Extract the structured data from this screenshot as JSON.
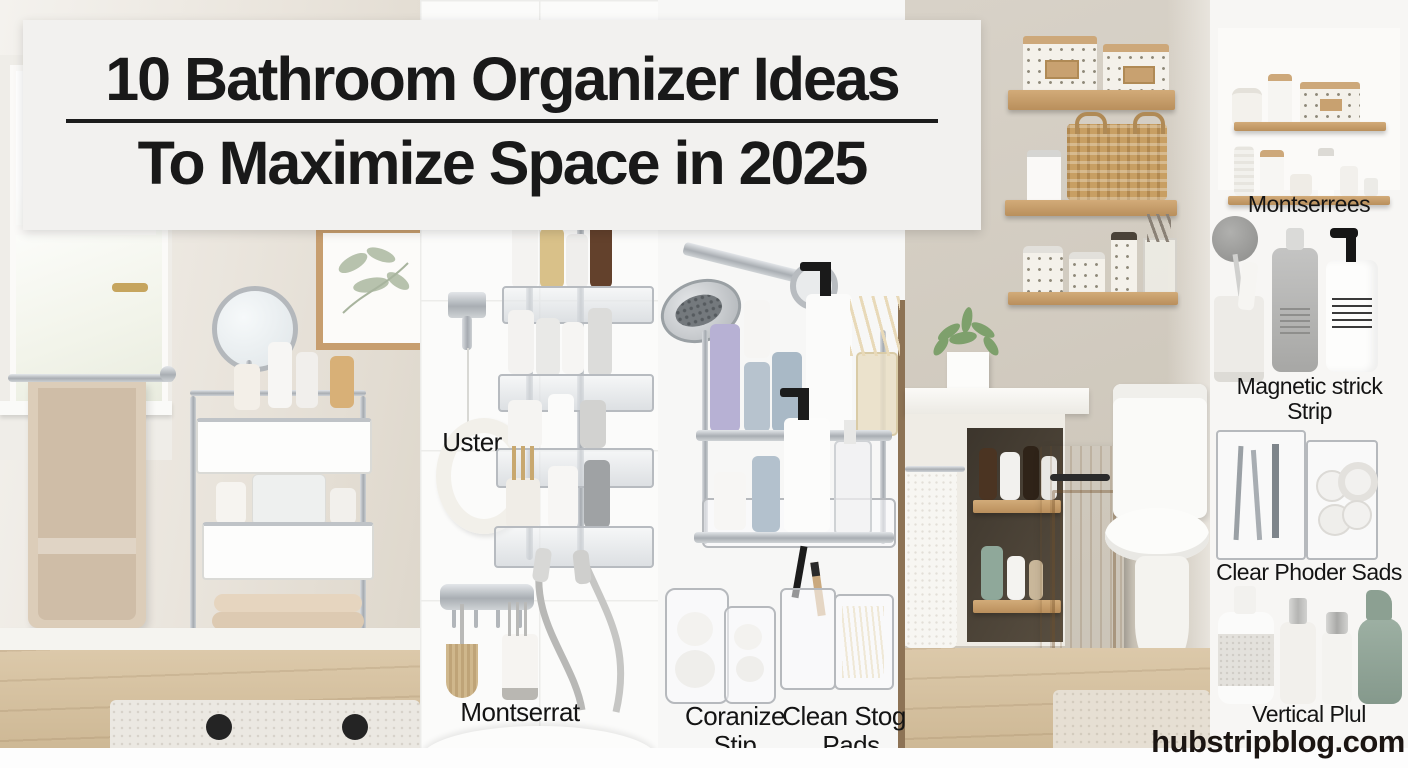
{
  "banner": {
    "title_line1": "10 Bathroom Organizer Ideas",
    "title_line2": "To Maximize Space in 2025"
  },
  "collage": {
    "shower_caddy_panel": {
      "hook_label": "Uster",
      "rail_label": "Montserrat"
    },
    "shower_shelf_panel": {
      "left_label": "Coranize Stip",
      "right_label": "Clean Stoge Pads"
    }
  },
  "sidebar": {
    "items": [
      {
        "label": "Montserrees"
      },
      {
        "label": "Magnetic strick Strip"
      },
      {
        "label": "Clear Phoder Sads"
      },
      {
        "label": "Vertical Plul"
      }
    ],
    "website": "hubstripblog.com"
  },
  "colors": {
    "banner_bg": "#f2f1ef",
    "title_text": "#191919",
    "label_text": "#141414",
    "website_text": "#1b1512",
    "wall_greige": "#cdc6ba",
    "wood_shelf": "#c79f6e",
    "floor_wood": "#d2bd9c",
    "towel_beige": "#d5c3ae",
    "chrome": "#c3c6c9",
    "sage_bottle": "#94a89c"
  }
}
